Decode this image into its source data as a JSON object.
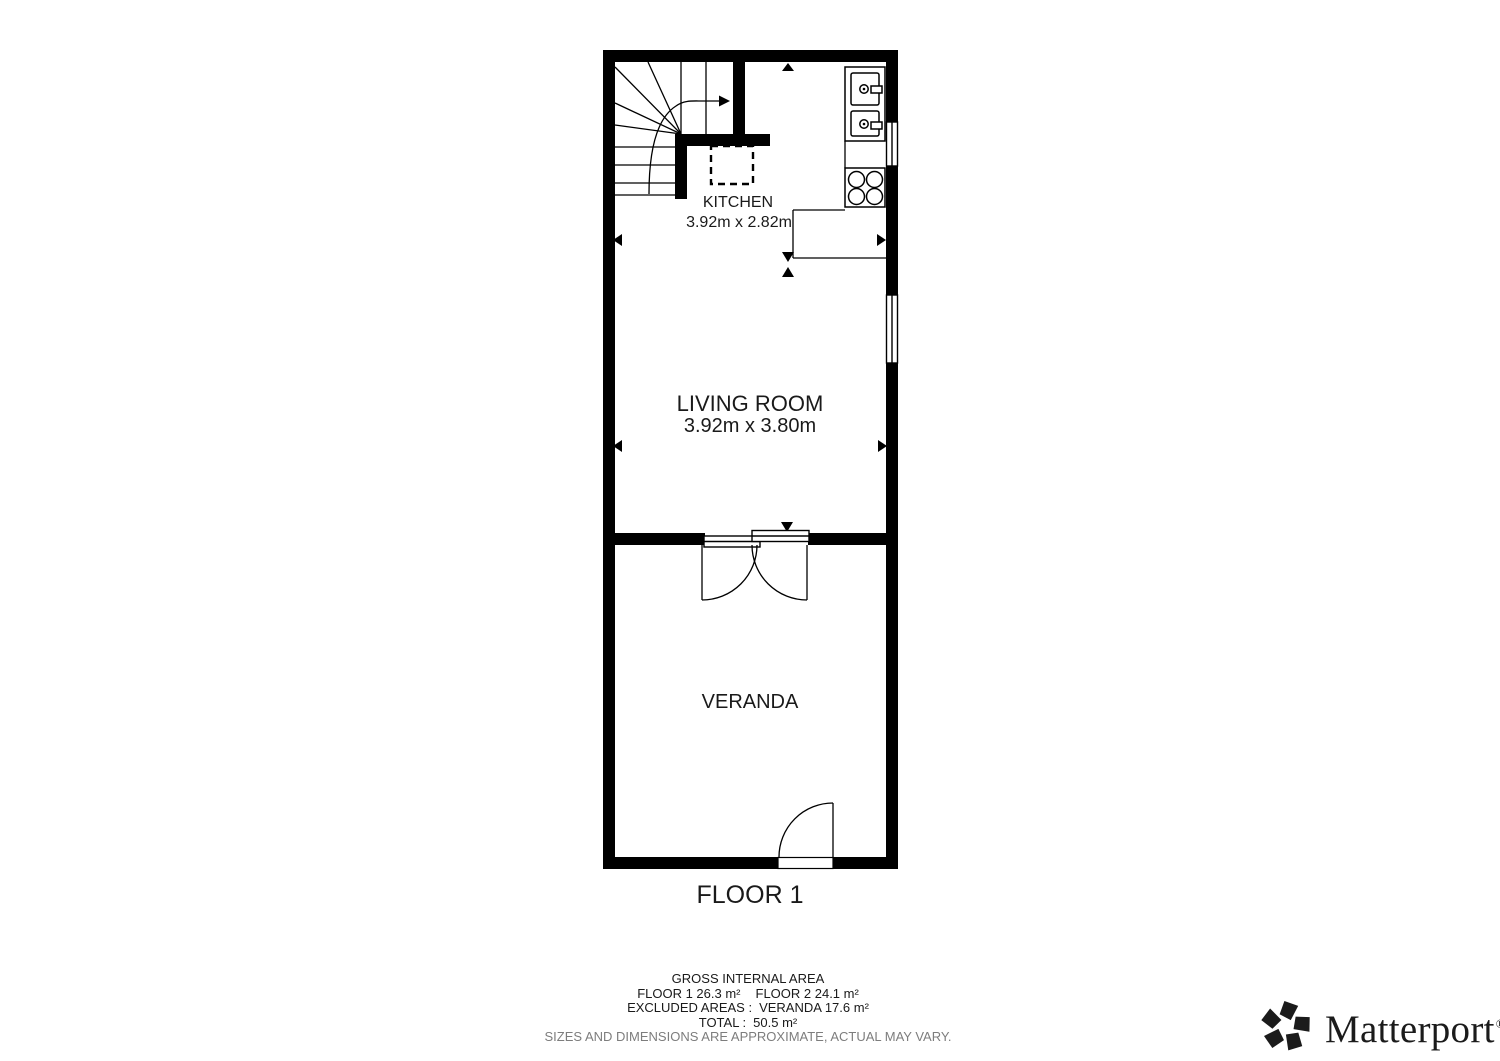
{
  "plan": {
    "floor_label": "FLOOR 1",
    "rooms": {
      "kitchen": {
        "name": "KITCHEN",
        "dims": "3.92m x 2.82m"
      },
      "living": {
        "name": "LIVING ROOM",
        "dims": "3.92m x 3.80m"
      },
      "veranda": {
        "name": "VERANDA"
      }
    }
  },
  "summary": {
    "title": "GROSS INTERNAL AREA",
    "floor1_area": "FLOOR 1 26.3 m²",
    "floor2_area": "FLOOR 2 24.1 m²",
    "excluded_label": "EXCLUDED AREAS :",
    "excluded_value": "VERANDA 17.6 m²",
    "total_label": "TOTAL :",
    "total_value": "50.5 m²",
    "disclaimer": "SIZES AND DIMENSIONS ARE APPROXIMATE, ACTUAL MAY VARY."
  },
  "branding": {
    "name": "Matterport",
    "registered": "®"
  },
  "colors": {
    "wall": "#000000",
    "text": "#1a1a1a",
    "muted": "#7d7d7d",
    "logo": "#1b1b1b",
    "background": "#ffffff"
  }
}
